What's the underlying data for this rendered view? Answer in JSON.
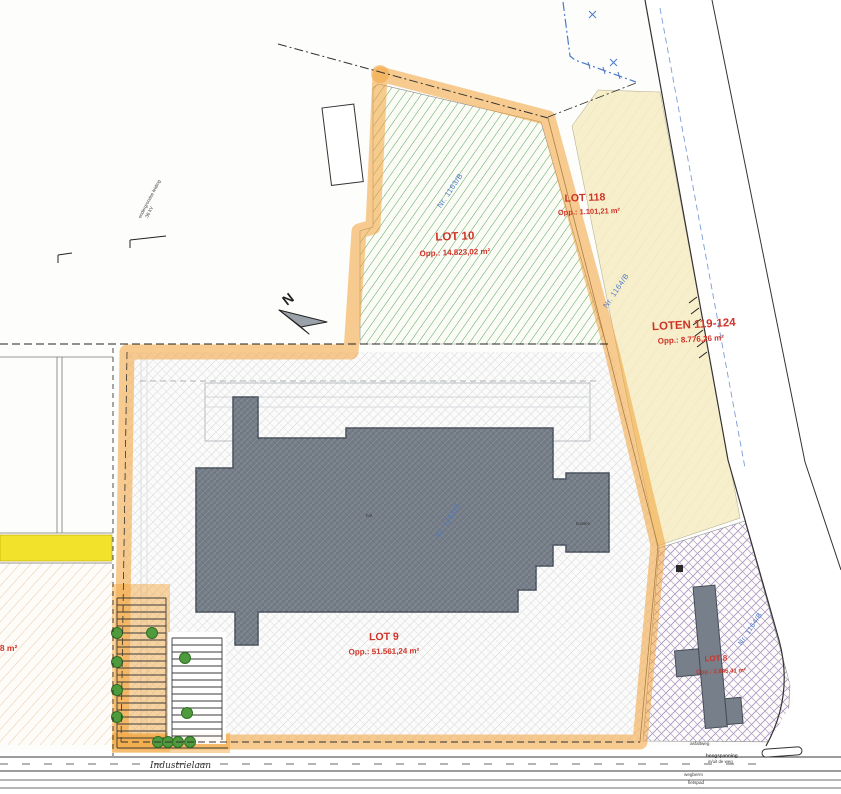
{
  "north_label": "N",
  "lots": [
    {
      "name": "LOT 10",
      "area": "Opp.: 14.823,02 m²",
      "parcel": "Nr. 1163/B"
    },
    {
      "name": "LOT 118",
      "area": "Opp.: 1.101,21 m²"
    },
    {
      "name": "LOTEN 119-124",
      "area": "Opp.: 8.776,26 m²",
      "parcel": "Nr. 1164/B"
    },
    {
      "name": "LOT 9",
      "area": "Opp.: 51.561,24 m²",
      "parcel": "Nr. 1163/B"
    },
    {
      "name": "LOT 8",
      "area": "Opp.: 2.845,41 m²",
      "parcel": "Nr. 1164/B"
    },
    {
      "name": "",
      "area": "8,48 m²"
    }
  ],
  "road": {
    "name": "Industrielaan",
    "labels": [
      "asfaltweg",
      "hoogspanning",
      "in/uit de weg",
      "wegberm",
      "fietspad"
    ]
  },
  "annotations": {
    "utility_line_1": "ondergrondse leiding",
    "utility_line_2": "36 kV",
    "hall": "hal",
    "annex": "burelen"
  },
  "colors": {
    "highlight_orange": "#F2A236",
    "lot10_hatch_green": "#55A556",
    "loten_cream": "#F7EFCB",
    "building_gray": "#747D87",
    "lot8_lattice_purple": "#9E93C9",
    "label_red": "#CF3227",
    "parcel_blue": "#4B79C9",
    "yellow_strip": "#F3E22B"
  }
}
